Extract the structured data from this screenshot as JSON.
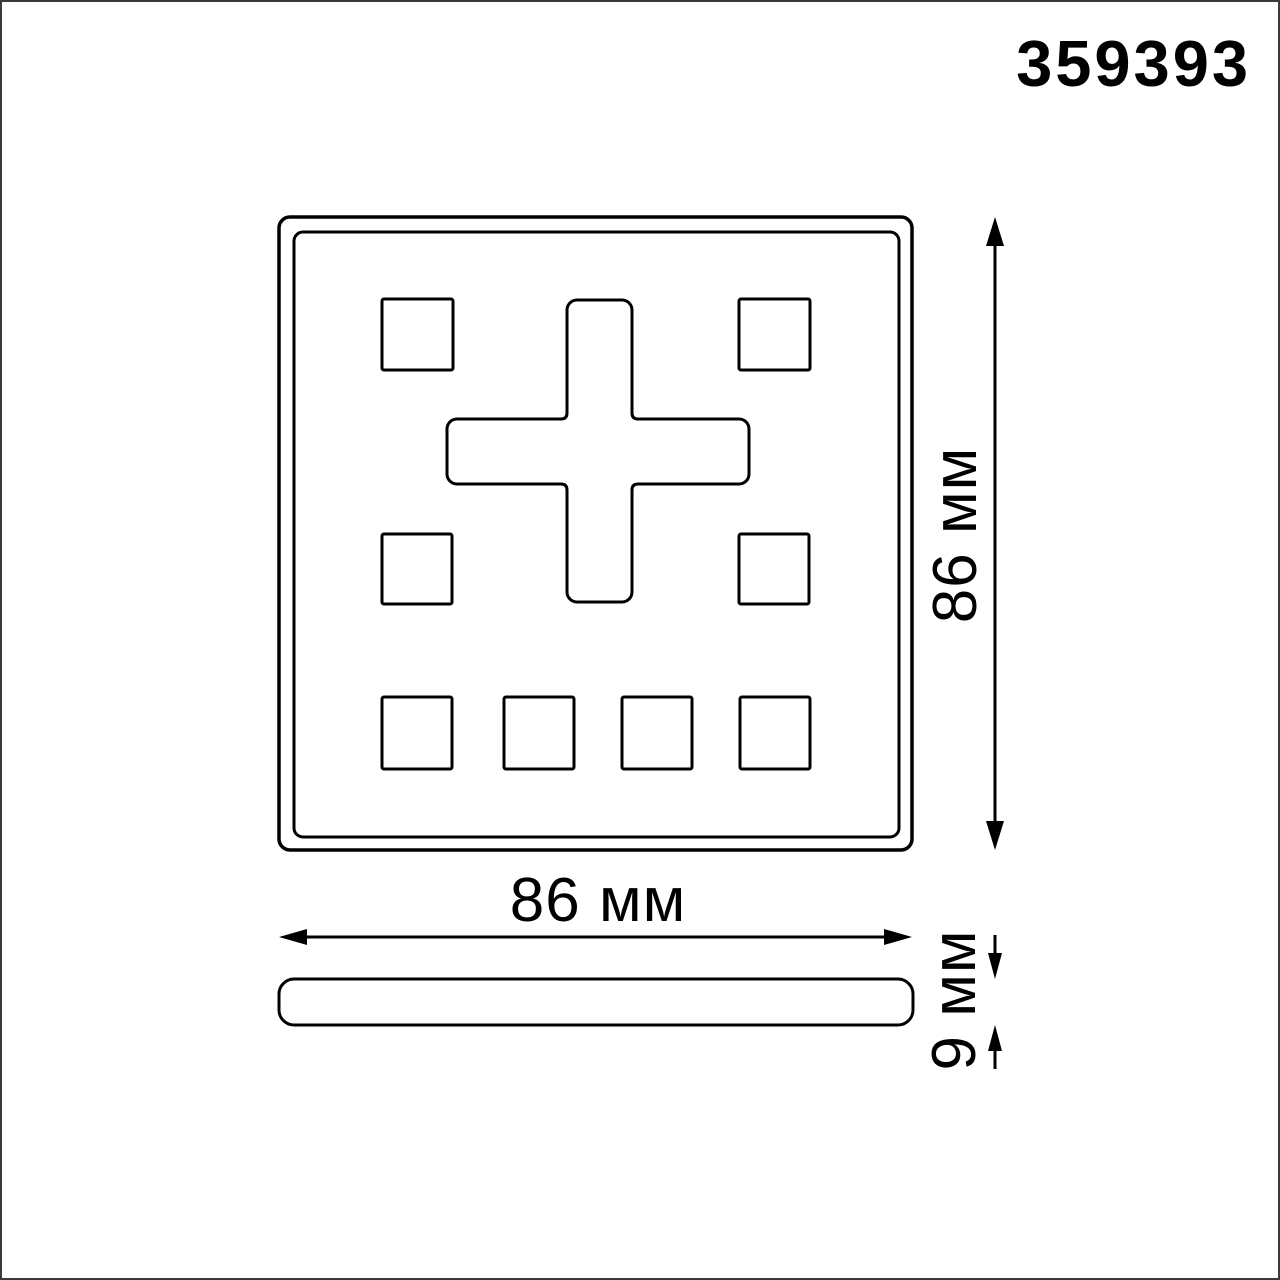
{
  "article_number": "359393",
  "drawing": {
    "line_color": "#000000",
    "background_color": "#ffffff",
    "frame_color": "#3a3a3a",
    "front_view": {
      "description": "square faceplate with 8 small square buttons and one plus-shaped button",
      "width_dimension": "86 мм",
      "height_dimension": "86 мм"
    },
    "side_view": {
      "description": "thin flat panel profile",
      "thickness_dimension": "9 мм"
    }
  }
}
